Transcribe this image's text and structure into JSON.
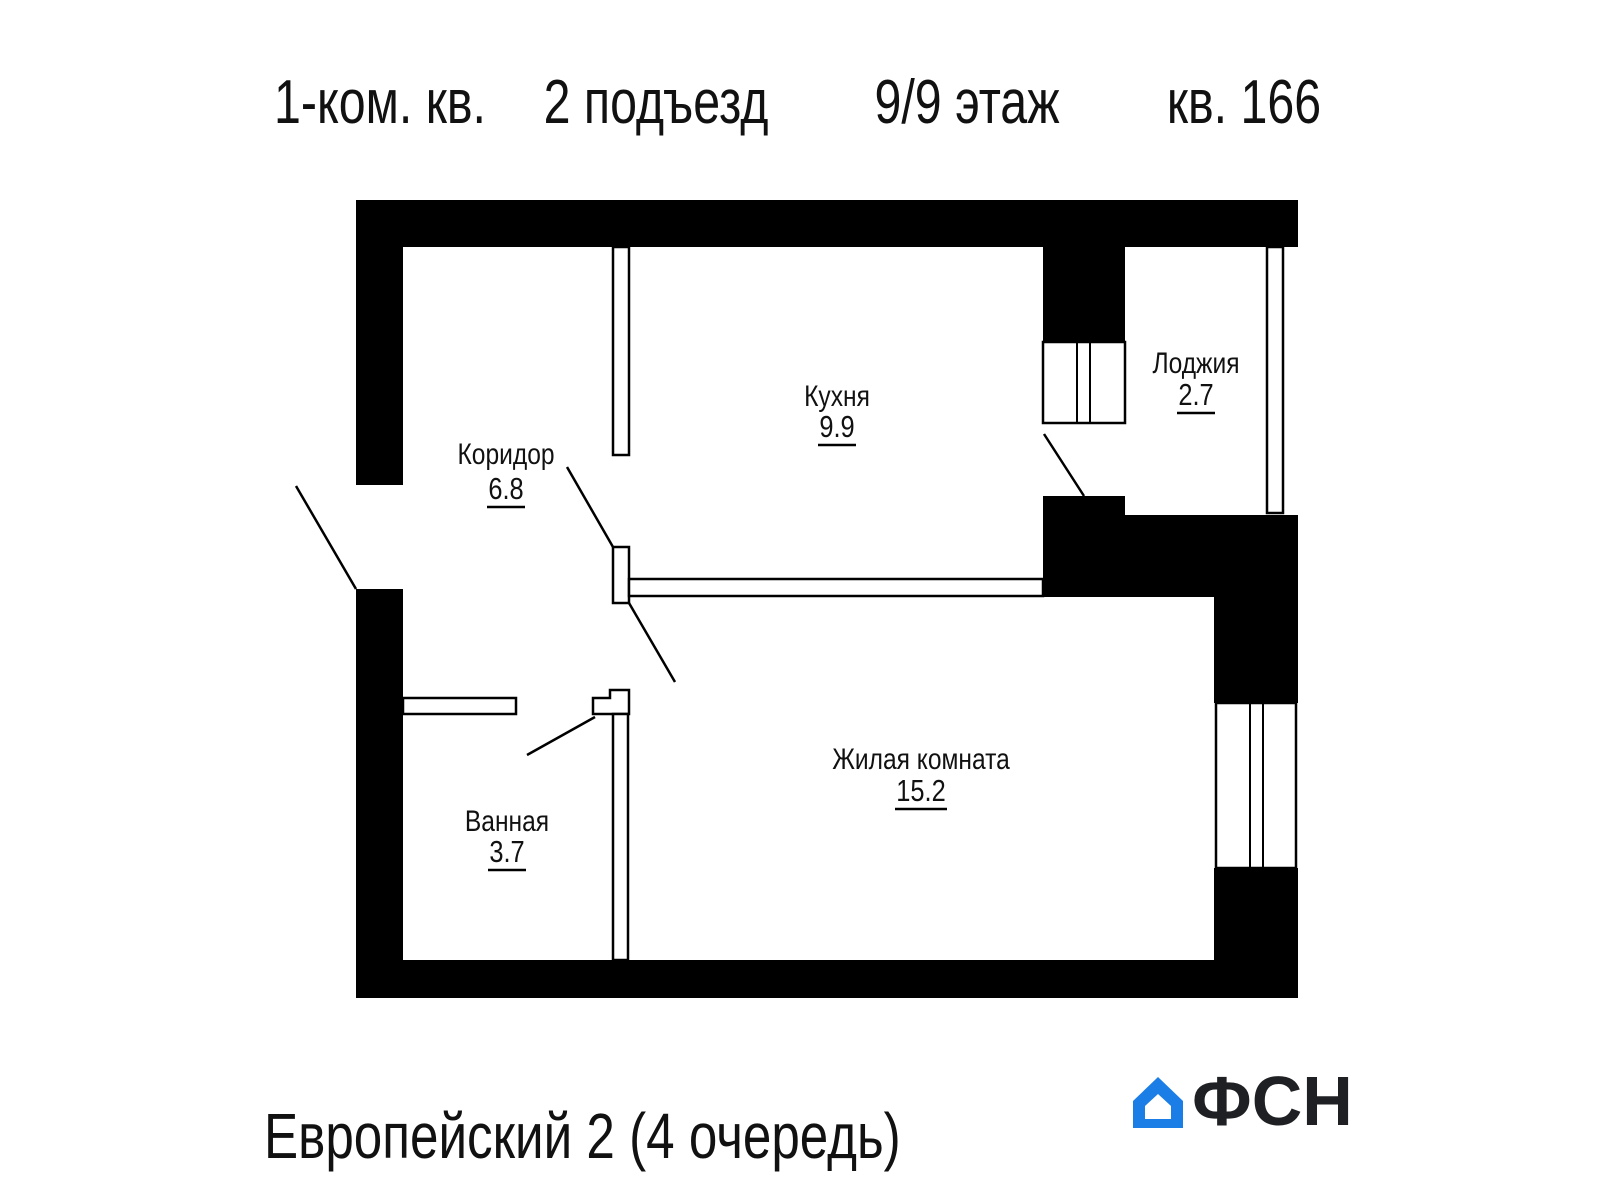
{
  "title": {
    "unit_type": "1-ком. кв.",
    "entrance": "2 подъезд",
    "floor": "9/9 этаж",
    "apartment": "кв. 166"
  },
  "rooms": [
    {
      "name": "Коридор",
      "area": "6.8"
    },
    {
      "name": "Кухня",
      "area": "9.9"
    },
    {
      "name": "Лоджия",
      "area": "2.7"
    },
    {
      "name": "Ванная",
      "area": "3.7"
    },
    {
      "name": "Жилая комната",
      "area": "15.2"
    }
  ],
  "footer": {
    "project": "Европейский 2 (4 очередь)",
    "logo_text": "ФСН"
  },
  "colors": {
    "wall": "#000000",
    "text": "#111111",
    "logo_blue": "#1b7de6",
    "logo_dark": "#1f2023"
  }
}
